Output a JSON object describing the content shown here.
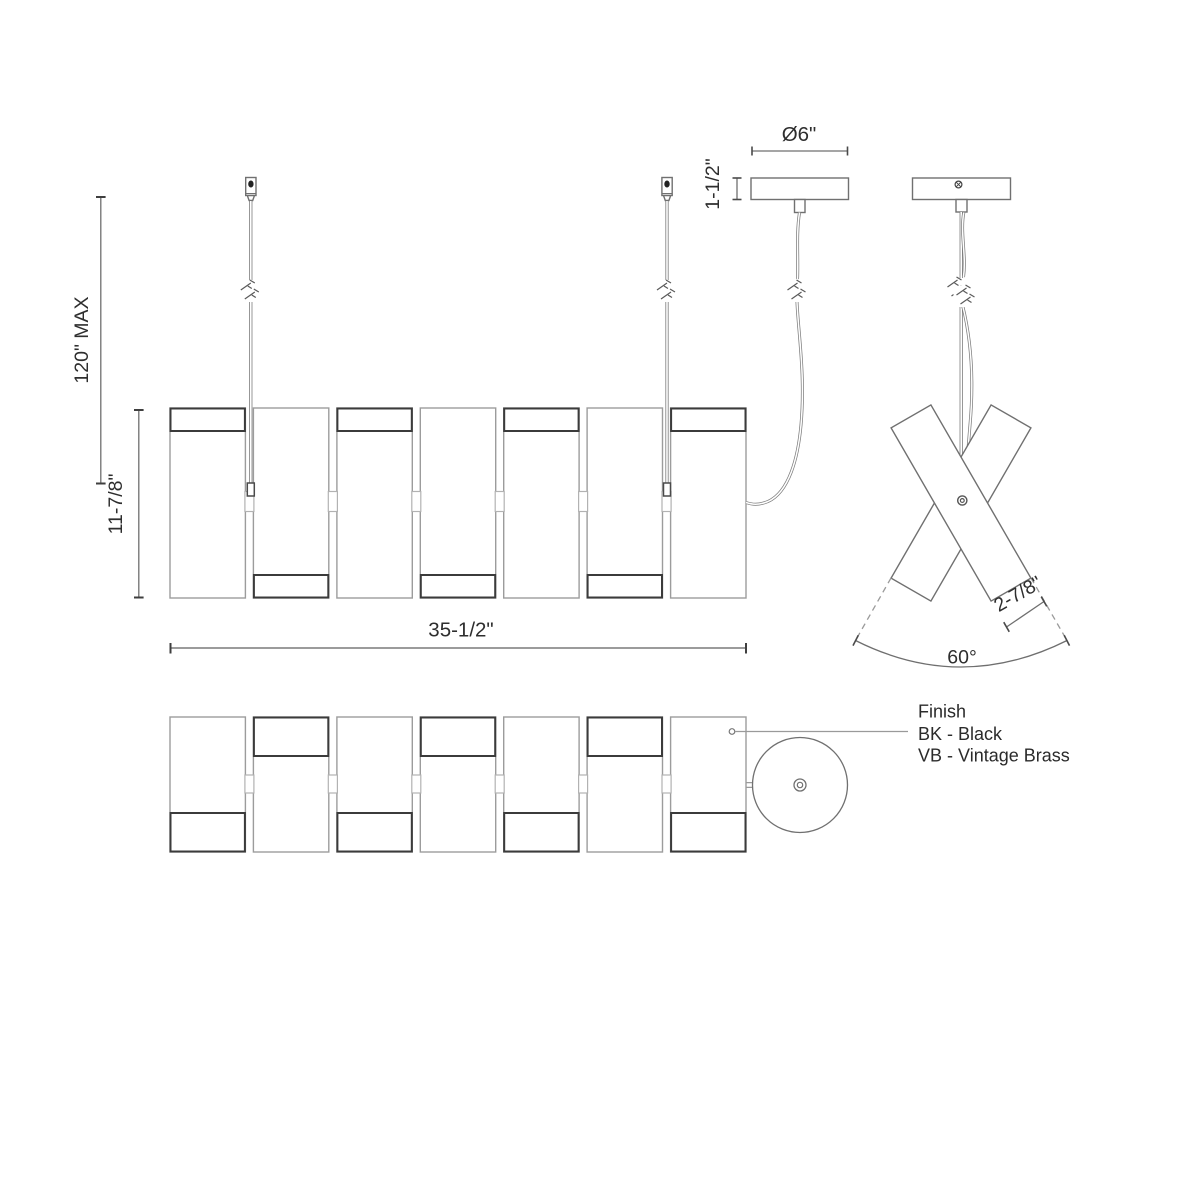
{
  "colors": {
    "background": "#ffffff",
    "line_light": "#9c9c9c",
    "line_medium": "#707070",
    "line_dark": "#3b3b3b",
    "dimension_line": "#6f6f6f",
    "text": "#2e2e2e"
  },
  "front_view": {
    "dim_suspension_max": "120\" MAX",
    "dim_fixture_height": "11-7/8\"",
    "dim_fixture_length": "35-1/2\""
  },
  "canopy_detail": {
    "dim_diameter": "Ø6\"",
    "dim_height": "1-1/2\""
  },
  "end_view": {
    "dim_blade_width": "2-7/8\"",
    "dim_spread_angle": "60°"
  },
  "finish_legend": {
    "title": "Finish",
    "options": [
      "BK - Black",
      "VB - Vintage Brass"
    ]
  }
}
